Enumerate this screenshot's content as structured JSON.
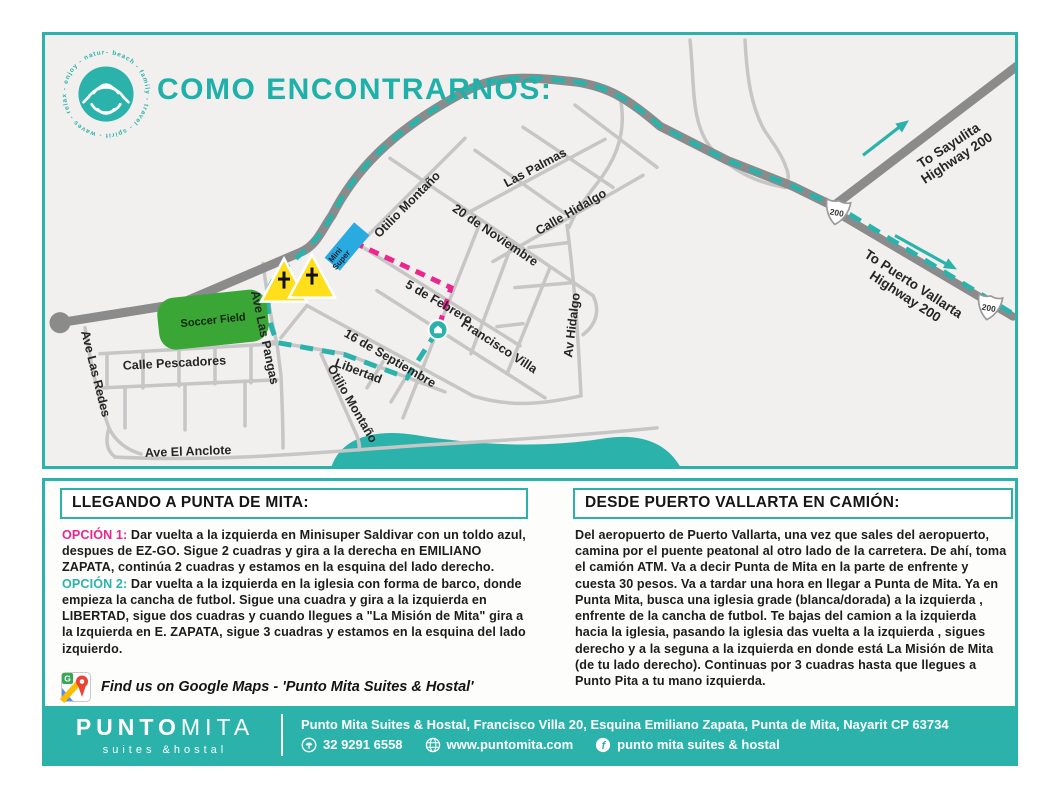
{
  "title": "COMO ENCONTRARNOS:",
  "logo": {
    "ring_text": "- beach - family - travel - spirit - waves - relax - enjoy - nature "
  },
  "map": {
    "streets": {
      "otilio_montano_upper": "Otilio Montaño",
      "veinte_noviembre": "20 de Noviembre",
      "las_palmas": "Las Palmas",
      "calle_hidalgo": "Calle Hidalgo",
      "cinco_febrero": "5 de Febrero",
      "francisco_villa": "Francisco Villa",
      "dieciseis_septiembre": "16 de Septiembre",
      "av_hidalgo": "Av Hidalgo",
      "libertad": "Libertad",
      "otilio_montano_lower": "Otilio Montaño",
      "calle_pescadores": "Calle Pescadores",
      "ave_las_redes": "Ave Las Redes",
      "ave_el_anclote": "Ave El Anclote",
      "ave_las_pangas": "Ave Las Pangas"
    },
    "landmarks": {
      "soccer_field": "Soccer Field",
      "mini_super_line1": "Mini",
      "mini_super_line2": "Super"
    },
    "highway": {
      "sayulita_1": "To Sayulita",
      "sayulita_2": "Highway 200",
      "pv_1": "To Puerto Vallarta",
      "pv_2": "Highway 200",
      "shield": "200"
    }
  },
  "left": {
    "heading": "LLEGANDO A PUNTA DE MITA:",
    "opt1_label": "OPCIÓN 1:",
    "opt1_text": " Dar vuelta a la izquierda en Minisuper Saldivar con un toldo azul, despues de EZ-GO. Sigue 2 cuadras y gira a la derecha en EMILIANO ZAPATA, continúa 2 cuadras y estamos en la esquina del lado derecho.",
    "opt2_label": "OPCIÓN 2:",
    "opt2_text": " Dar vuelta a la izquierda en la iglesia con forma de barco, donde empieza la cancha de futbol. Sigue una cuadra y gira a la izquierda en LIBERTAD, sigue dos cuadras y cuando llegues a \"La Misión de Mita\" gira a la Izquierda en E. ZAPATA, sigue 3 cuadras y estamos en la esquina del lado izquierdo.",
    "google_maps_text": "Find us on Google Maps - 'Punto Mita Suites & Hostal'"
  },
  "right": {
    "heading": "DESDE PUERTO VALLARTA EN CAMIÓN:",
    "body": "Del aeropuerto de Puerto Vallarta, una vez que sales del aeropuerto, camina por el puente peatonal al otro lado de la carretera. De ahí, toma el camión ATM. Va a decir Punta de Mita en la parte de enfrente y cuesta 30 pesos. Va a tardar una hora en llegar a Punta de Mita. Ya en Punta Mita, busca una iglesia grade (blanca/dorada) a la izquierda , enfrente de la cancha de futbol. Te bajas del camion a la izquierda hacia la iglesia, pasando la iglesia das vuelta a la izquierda , sigues derecho y a la seguna a la izquierda en donde está La Misión de Mita (de tu lado derecho). Continuas por 3 cuadras hasta que llegues a Punto Pita a tu mano izquierda."
  },
  "footer": {
    "brand_a": "PUNTO",
    "brand_b": "MITA",
    "tagline": "suites &hostal",
    "address": "Punto Mita Suites & Hostal, Francisco Villa 20, Esquina Emiliano Zapata, Punta de Mita, Nayarit CP 63734",
    "phone": "32 9291 6558",
    "website": "www.puntomita.com",
    "facebook": "punto mita suites & hostal"
  },
  "colors": {
    "teal": "#2bb3ab",
    "pink": "#ec268e",
    "yellow": "#ffdf1b",
    "green": "#3aa636",
    "blue": "#29abe2",
    "road_dark": "#8b8b8b",
    "road_light": "#c6c6c6"
  }
}
